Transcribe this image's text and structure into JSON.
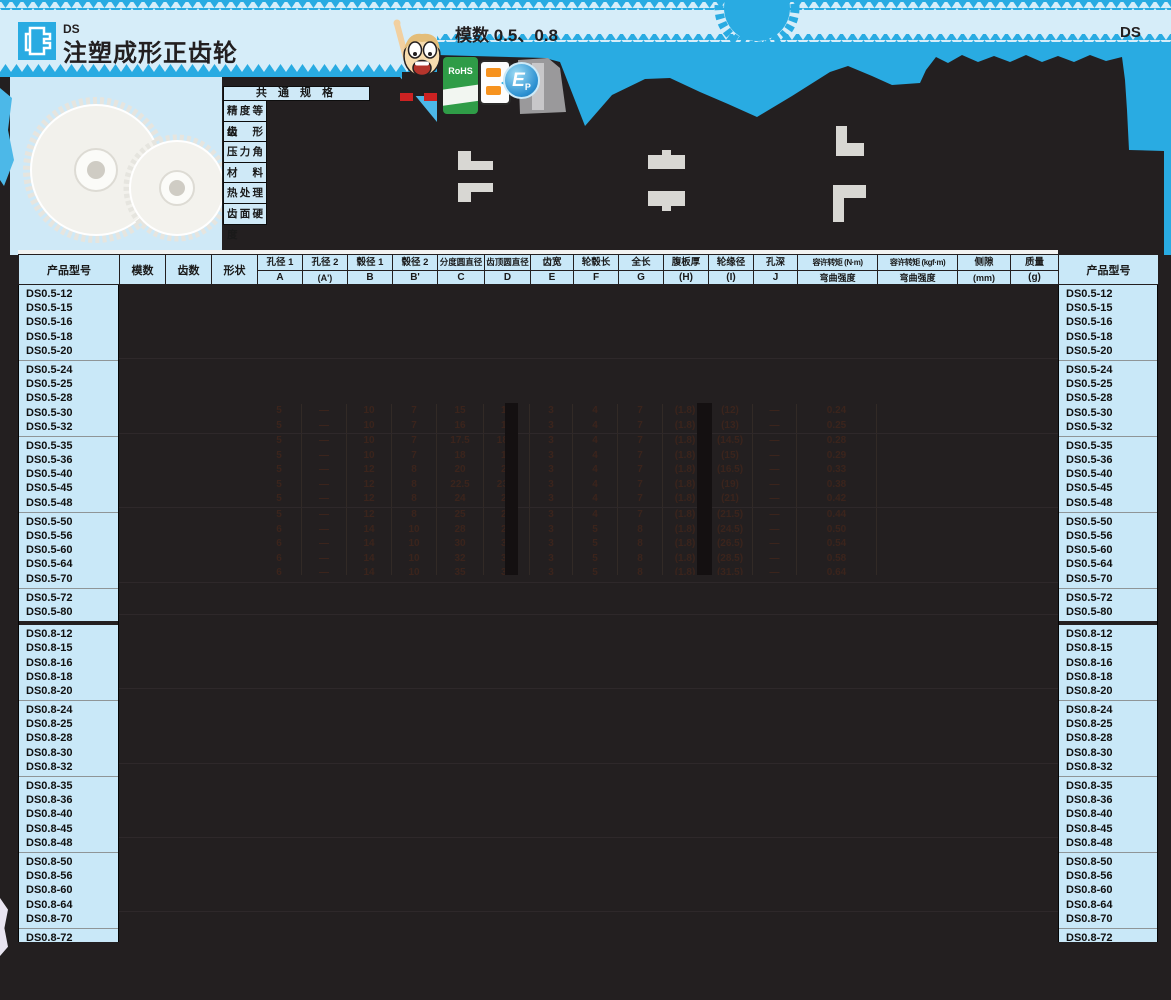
{
  "header": {
    "series_code": "DS",
    "title": "注塑成形正齿轮",
    "module_note": "模数 0.5、0.8",
    "page_code": "DS"
  },
  "common_spec": {
    "title": "共 通 规 格",
    "labels": [
      "精度等级",
      "齿形",
      "压力角",
      "材料",
      "热处理",
      "齿面硬度"
    ]
  },
  "badges": {
    "rohs": "RoHS",
    "ep_main": "E",
    "ep_sub": "P"
  },
  "table": {
    "columns": [
      {
        "top": "产品型号",
        "span": true
      },
      {
        "top": "模数",
        "span": true
      },
      {
        "top": "齿数",
        "span": true
      },
      {
        "top": "形状",
        "span": true
      },
      {
        "top": "孔径 1",
        "bottom": "A"
      },
      {
        "top": "孔径 2",
        "bottom": "(A')"
      },
      {
        "top": "毂径 1",
        "bottom": "B"
      },
      {
        "top": "毂径 2",
        "bottom": "B'"
      },
      {
        "top": "分度圆直径",
        "bottom": "C"
      },
      {
        "top": "齿顶圆直径",
        "bottom": "D"
      },
      {
        "top": "齿宽",
        "bottom": "E"
      },
      {
        "top": "轮毂长",
        "bottom": "F"
      },
      {
        "top": "全长",
        "bottom": "G"
      },
      {
        "top": "腹板厚",
        "bottom": "(H)"
      },
      {
        "top": "轮缘径",
        "bottom": "(I)"
      },
      {
        "top": "孔深",
        "bottom": "J"
      },
      {
        "top": "容许转矩 (N·m)",
        "bottom": "弯曲强度"
      },
      {
        "top": "容许转矩 (kgf·m)",
        "bottom": "弯曲强度"
      },
      {
        "top": "侧隙",
        "bottom": "(mm)"
      },
      {
        "top": "质量",
        "bottom": "(g)"
      },
      {
        "top": "产品型号",
        "span": true
      }
    ],
    "model_groups": [
      [
        "DS0.5-12",
        "DS0.5-15",
        "DS0.5-16",
        "DS0.5-18",
        "DS0.5-20"
      ],
      [
        "DS0.5-24",
        "DS0.5-25",
        "DS0.5-28",
        "DS0.5-30",
        "DS0.5-32"
      ],
      [
        "DS0.5-35",
        "DS0.5-36",
        "DS0.5-40",
        "DS0.5-45",
        "DS0.5-48"
      ],
      [
        "DS0.5-50",
        "DS0.5-56",
        "DS0.5-60",
        "DS0.5-64",
        "DS0.5-70"
      ],
      [
        "DS0.5-72",
        "DS0.5-80"
      ],
      [
        "DS0.8-12",
        "DS0.8-15",
        "DS0.8-16",
        "DS0.8-18",
        "DS0.8-20"
      ],
      [
        "DS0.8-24",
        "DS0.8-25",
        "DS0.8-28",
        "DS0.8-30",
        "DS0.8-32"
      ],
      [
        "DS0.8-35",
        "DS0.8-36",
        "DS0.8-40",
        "DS0.8-45",
        "DS0.8-48"
      ],
      [
        "DS0.8-50",
        "DS0.8-56",
        "DS0.8-60",
        "DS0.8-64",
        "DS0.8-70"
      ],
      [
        "DS0.8-72",
        "DS0.8-80"
      ]
    ],
    "faint_rows": [
      {
        "model": "DS0.5-30",
        "values": [
          "5",
          "—",
          "10",
          "7",
          "15",
          "16",
          "3",
          "4",
          "7",
          "(1.8)",
          "(12)",
          "—",
          "0.24"
        ]
      },
      {
        "model": "DS0.5-32",
        "values": [
          "5",
          "—",
          "10",
          "7",
          "16",
          "17",
          "3",
          "4",
          "7",
          "(1.8)",
          "(13)",
          "—",
          "0.25"
        ]
      },
      {
        "model": "DS0.5-35",
        "values": [
          "5",
          "—",
          "10",
          "7",
          "17.5",
          "18.5",
          "3",
          "4",
          "7",
          "(1.8)",
          "(14.5)",
          "—",
          "0.28"
        ]
      },
      {
        "model": "DS0.5-36",
        "values": [
          "5",
          "—",
          "10",
          "7",
          "18",
          "19",
          "3",
          "4",
          "7",
          "(1.8)",
          "(15)",
          "—",
          "0.29"
        ]
      },
      {
        "model": "DS0.5-40",
        "values": [
          "5",
          "—",
          "12",
          "8",
          "20",
          "21",
          "3",
          "4",
          "7",
          "(1.8)",
          "(16.5)",
          "—",
          "0.33"
        ]
      },
      {
        "model": "DS0.5-45",
        "values": [
          "5",
          "—",
          "12",
          "8",
          "22.5",
          "23.5",
          "3",
          "4",
          "7",
          "(1.8)",
          "(19)",
          "—",
          "0.38"
        ]
      },
      {
        "model": "DS0.5-48",
        "values": [
          "5",
          "—",
          "12",
          "8",
          "24",
          "25",
          "3",
          "4",
          "7",
          "(1.8)",
          "(21)",
          "—",
          "0.42"
        ]
      },
      {
        "model": "DS0.5-50",
        "values": [
          "5",
          "—",
          "12",
          "8",
          "25",
          "26",
          "3",
          "4",
          "7",
          "(1.8)",
          "(21.5)",
          "—",
          "0.44"
        ]
      },
      {
        "model": "DS0.5-56",
        "values": [
          "6",
          "—",
          "14",
          "10",
          "28",
          "29",
          "3",
          "5",
          "8",
          "(1.8)",
          "(24.5)",
          "—",
          "0.50"
        ]
      },
      {
        "model": "DS0.5-60",
        "values": [
          "6",
          "—",
          "14",
          "10",
          "30",
          "31",
          "3",
          "5",
          "8",
          "(1.8)",
          "(26.5)",
          "—",
          "0.54"
        ]
      },
      {
        "model": "DS0.5-64",
        "values": [
          "6",
          "—",
          "14",
          "10",
          "32",
          "33",
          "3",
          "5",
          "8",
          "(1.8)",
          "(28.5)",
          "—",
          "0.58"
        ]
      },
      {
        "model": "DS0.5-70",
        "values": [
          "6",
          "—",
          "14",
          "10",
          "35",
          "36",
          "3",
          "5",
          "8",
          "(1.8)",
          "(31.5)",
          "—",
          "0.64"
        ]
      }
    ]
  },
  "colors": {
    "accent_cyan": "#29abe2",
    "panel_lightblue": "#d6edf9",
    "cell_blue": "#c9e8f8",
    "ink_black": "#231f20",
    "rohs_green": "#2f9c47"
  }
}
